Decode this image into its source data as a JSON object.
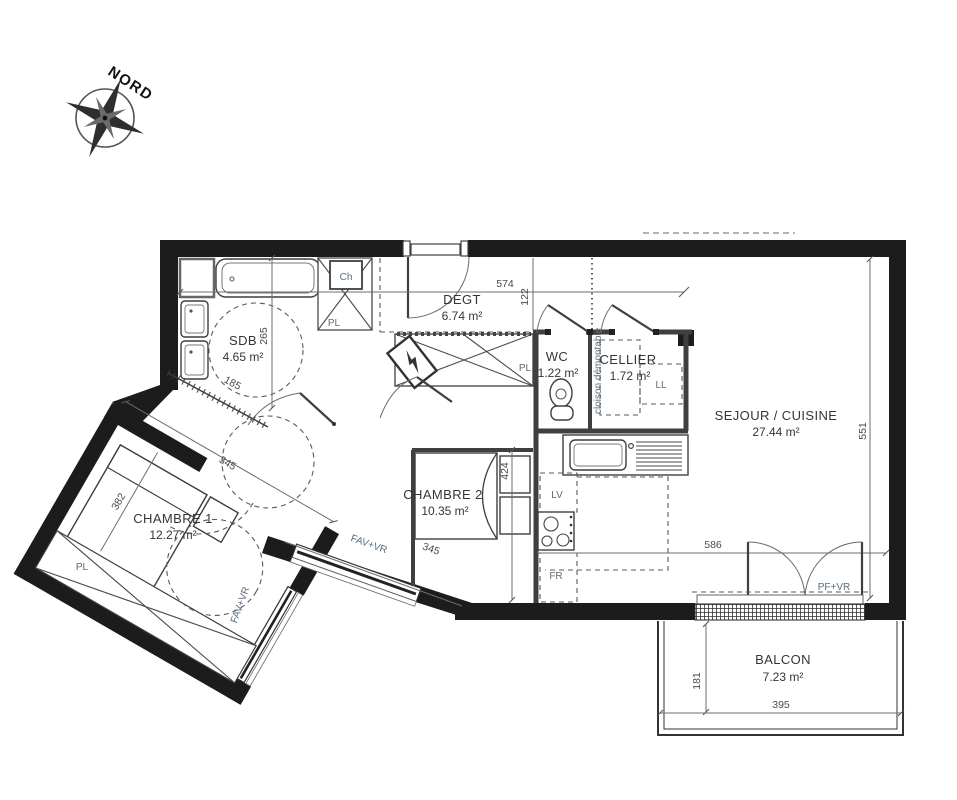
{
  "compass": {
    "label": "NORD"
  },
  "rooms": {
    "sdb": {
      "name": "SDB",
      "area": "4.65 m²"
    },
    "degt": {
      "name": "DEGT",
      "area": "6.74 m²"
    },
    "wc": {
      "name": "WC",
      "area": "1.22 m²"
    },
    "cellier": {
      "name": "CELLIER",
      "area": "1.72 m²"
    },
    "sejour": {
      "name": "SEJOUR / CUISINE",
      "area": "27.44 m²"
    },
    "chambre1": {
      "name": "CHAMBRE 1",
      "area": "12.27 m²"
    },
    "chambre2": {
      "name": "CHAMBRE 2",
      "area": "10.35 m²"
    },
    "balcon": {
      "name": "BALCON",
      "area": "7.23 m²"
    }
  },
  "dimensions_cm": {
    "sdb_height": "265",
    "sdb_width": "185",
    "entry_width": "574",
    "entry_depth": "122",
    "sejour_height": "551",
    "sejour_width": "586",
    "chambre2_height": "424",
    "chambre2_width": "345",
    "chambre1_width": "345",
    "chambre1_depth": "382",
    "balcon_depth": "181",
    "balcon_width": "395"
  },
  "fixture_labels": {
    "water_heater": "Ch",
    "closet": "PL",
    "washing_machine": "LL",
    "dishwasher": "LV",
    "fridge": "FR",
    "removable_partition": "cloison démontable",
    "window_chambre1": "FAV+VR",
    "window_chambre2": "FAV+VR",
    "balcony_door": "PF+VR"
  },
  "colors": {
    "wall": "#1c1c1c",
    "line": "#3f3f3f",
    "dim_text": "#4a4a4a",
    "fixture_text": "#5a6b7c",
    "label_text": "#353535"
  }
}
